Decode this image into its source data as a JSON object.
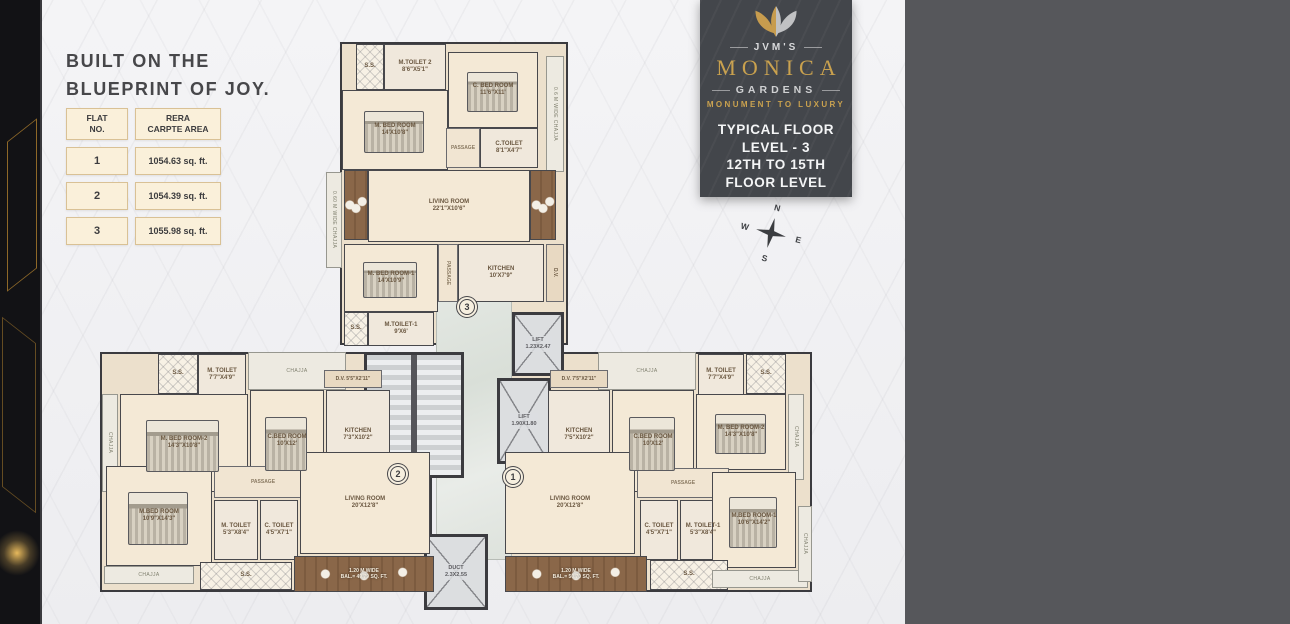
{
  "headline": {
    "text": "BUILT ON THE\nBLUEPRINT OF JOY."
  },
  "area_table": {
    "col1_header": "FLAT\nNO.",
    "col2_header": "RERA\nCARPTE AREA",
    "rows": [
      {
        "flat": "1",
        "area": "1054.63 sq. ft."
      },
      {
        "flat": "2",
        "area": "1054.39 sq. ft."
      },
      {
        "flat": "3",
        "area": "1055.98 sq. ft."
      }
    ]
  },
  "brand": {
    "name_prefix": "JVM'S",
    "name": "MONICA",
    "name_suffix": "GARDENS",
    "tagline": "MONUMENT TO LUXURY",
    "floor_info": "TYPICAL FLOOR\nLEVEL - 3\n12TH TO 15TH\nFLOOR LEVEL",
    "gold": "#c9a14e"
  },
  "compass": {
    "north": "N",
    "east": "E",
    "south": "S",
    "west": "W"
  },
  "floor_plan": {
    "flat_markers": [
      {
        "no": "3",
        "x": 467,
        "y": 307
      },
      {
        "no": "2",
        "x": 398,
        "y": 474
      },
      {
        "no": "1",
        "x": 513,
        "y": 477
      }
    ],
    "outlines": [
      {
        "name": "flat-3-outline",
        "x": 340,
        "y": 42,
        "w": 228,
        "h": 303
      },
      {
        "name": "flat-2-outline",
        "x": 100,
        "y": 352,
        "w": 332,
        "h": 240
      },
      {
        "name": "flat-1-outline",
        "x": 505,
        "y": 352,
        "w": 307,
        "h": 240
      }
    ],
    "rooms": [
      {
        "name": "lobby",
        "type": "lobby",
        "label": "",
        "x": 436,
        "y": 268,
        "w": 76,
        "h": 292
      },
      {
        "name": "staircase",
        "type": "stairs",
        "label": "",
        "x": 364,
        "y": 352,
        "w": 100,
        "h": 126
      },
      {
        "name": "lift-1",
        "type": "lift",
        "label": "LIFT\n1.23X2.47",
        "x": 512,
        "y": 312,
        "w": 52,
        "h": 64
      },
      {
        "name": "lift-2",
        "type": "lift",
        "label": "LIFT\n1.90X1.80",
        "x": 497,
        "y": 378,
        "w": 54,
        "h": 86
      },
      {
        "name": "duct",
        "type": "duct",
        "label": "DUCT\n2.3X2.55",
        "x": 424,
        "y": 534,
        "w": 64,
        "h": 76
      },
      {
        "name": "flat3-ss-top",
        "type": "ss",
        "label": "S.S.",
        "x": 356,
        "y": 44,
        "w": 28,
        "h": 46
      },
      {
        "name": "flat3-m-toilet-2",
        "type": "wet",
        "label": "M.TOILET 2\n8'6\"X5'1\"",
        "x": 384,
        "y": 44,
        "w": 62,
        "h": 46
      },
      {
        "name": "flat3-c-bed-room",
        "type": "room",
        "furn": "bed",
        "label": "C. BED ROOM\n11'6\"X11'",
        "x": 448,
        "y": 52,
        "w": 90,
        "h": 76
      },
      {
        "name": "flat3-m-bed-room",
        "type": "room",
        "furn": "bed",
        "label": "M. BED ROOM\n14'X10'8\"",
        "x": 342,
        "y": 90,
        "w": 106,
        "h": 80
      },
      {
        "name": "flat3-passage-a",
        "type": "pass",
        "label": "PASSAGE",
        "x": 446,
        "y": 128,
        "w": 34,
        "h": 40
      },
      {
        "name": "flat3-c-toilet",
        "type": "wet",
        "label": "C.TOILET\n8'1\"X4'7\"",
        "x": 480,
        "y": 128,
        "w": 58,
        "h": 40
      },
      {
        "name": "flat3-chajja-right",
        "type": "chajja",
        "vert": true,
        "label": "0.6 M WIDE CHAJJA",
        "x": 546,
        "y": 56,
        "w": 18,
        "h": 116
      },
      {
        "name": "flat3-balcony-left",
        "type": "balcony",
        "label": "",
        "x": 344,
        "y": 170,
        "w": 24,
        "h": 70
      },
      {
        "name": "flat3-living-room",
        "type": "room",
        "label": "LIVING ROOM\n22'1\"X10'6\"",
        "x": 368,
        "y": 170,
        "w": 162,
        "h": 72
      },
      {
        "name": "flat3-balcony-right",
        "type": "balcony",
        "label": "",
        "x": 530,
        "y": 170,
        "w": 26,
        "h": 70
      },
      {
        "name": "flat3-chajja-left",
        "type": "chajja",
        "vert": true,
        "label": "0.60 M WIDE CHAJJA",
        "x": 326,
        "y": 172,
        "w": 16,
        "h": 96
      },
      {
        "name": "flat3-m-bed-room-1",
        "type": "room",
        "furn": "bed",
        "label": "M. BED ROOM-1\n14'X10'9\"",
        "x": 344,
        "y": 244,
        "w": 94,
        "h": 68
      },
      {
        "name": "flat3-passage-b",
        "type": "pass",
        "vert": true,
        "label": "PASSAGE",
        "x": 438,
        "y": 244,
        "w": 20,
        "h": 58
      },
      {
        "name": "flat3-kitchen",
        "type": "wet",
        "label": "KITCHEN\n10'X7'9\"",
        "x": 458,
        "y": 244,
        "w": 86,
        "h": 58
      },
      {
        "name": "flat3-dv",
        "type": "dv",
        "vert": true,
        "label": "D.V.",
        "x": 546,
        "y": 244,
        "w": 18,
        "h": 58
      },
      {
        "name": "flat3-ss-bottom",
        "type": "ss",
        "label": "S.S.",
        "x": 344,
        "y": 312,
        "w": 24,
        "h": 34
      },
      {
        "name": "flat3-m-toilet-1",
        "type": "wet",
        "label": "M.TOILET-1\n9'X6'",
        "x": 368,
        "y": 312,
        "w": 66,
        "h": 34
      },
      {
        "name": "flat2-ss-top",
        "type": "ss",
        "label": "S.S.",
        "x": 158,
        "y": 354,
        "w": 40,
        "h": 40
      },
      {
        "name": "flat2-m-toilet",
        "type": "wet",
        "label": "M. TOILET\n7'7\"X4'9\"",
        "x": 198,
        "y": 354,
        "w": 48,
        "h": 42
      },
      {
        "name": "flat2-chajja-top",
        "type": "chajja",
        "label": "CHAJJA",
        "x": 248,
        "y": 352,
        "w": 98,
        "h": 38
      },
      {
        "name": "flat2-chajja-left",
        "type": "chajja",
        "vert": true,
        "label": "CHAJJA",
        "x": 102,
        "y": 394,
        "w": 16,
        "h": 98
      },
      {
        "name": "flat2-m-bed-room-2",
        "type": "room",
        "furn": "bed",
        "label": "M. BED ROOM-2\n14'3\"X10'8\"",
        "x": 120,
        "y": 394,
        "w": 128,
        "h": 98
      },
      {
        "name": "flat2-c-bed-room",
        "type": "room",
        "furn": "bed",
        "label": "C.BED ROOM\n10'X12'",
        "x": 250,
        "y": 390,
        "w": 74,
        "h": 102
      },
      {
        "name": "flat2-dv",
        "type": "dv",
        "label": "D.V. 5'5\"X2'11\"",
        "x": 324,
        "y": 370,
        "w": 58,
        "h": 18
      },
      {
        "name": "flat2-kitchen",
        "type": "wet",
        "label": "KITCHEN\n7'3\"X10'2\"",
        "x": 326,
        "y": 390,
        "w": 64,
        "h": 90
      },
      {
        "name": "flat2-m-bed-room",
        "type": "room",
        "furn": "bed",
        "label": "M.BED ROOM\n10'9\"X14'3\"",
        "x": 106,
        "y": 466,
        "w": 106,
        "h": 100
      },
      {
        "name": "flat2-passage",
        "type": "pass",
        "label": "PASSAGE",
        "x": 214,
        "y": 466,
        "w": 98,
        "h": 32
      },
      {
        "name": "flat2-m-toilet-b",
        "type": "wet",
        "label": "M. TOILET\n5'3\"X8'4\"",
        "x": 214,
        "y": 500,
        "w": 44,
        "h": 60
      },
      {
        "name": "flat2-c-toilet",
        "type": "wet",
        "label": "C. TOILET\n4'5\"X7'1\"",
        "x": 260,
        "y": 500,
        "w": 38,
        "h": 60
      },
      {
        "name": "flat2-living-room",
        "type": "room",
        "label": "LIVING ROOM\n20'X12'8\"",
        "x": 300,
        "y": 452,
        "w": 130,
        "h": 102
      },
      {
        "name": "flat2-ss-bottom",
        "type": "ss",
        "label": "S.S.",
        "x": 200,
        "y": 562,
        "w": 92,
        "h": 28
      },
      {
        "name": "flat2-balcony",
        "type": "balcony",
        "label": "1.20 M WIDE\nBAL.= 49.79 SQ. FT.",
        "x": 294,
        "y": 556,
        "w": 140,
        "h": 36
      },
      {
        "name": "flat2-chajja-bottom",
        "type": "chajja",
        "label": "CHAJJA",
        "x": 104,
        "y": 566,
        "w": 90,
        "h": 18
      },
      {
        "name": "flat1-chajja-top",
        "type": "chajja",
        "label": "CHAJJA",
        "x": 598,
        "y": 352,
        "w": 98,
        "h": 38
      },
      {
        "name": "flat1-m-toilet",
        "type": "wet",
        "label": "M. TOILET\n7'7\"X4'9\"",
        "x": 698,
        "y": 354,
        "w": 46,
        "h": 42
      },
      {
        "name": "flat1-ss-top",
        "type": "ss",
        "label": "S.S.",
        "x": 746,
        "y": 354,
        "w": 40,
        "h": 40
      },
      {
        "name": "flat1-dv",
        "type": "dv",
        "label": "D.V. 7'5\"X2'11\"",
        "x": 550,
        "y": 370,
        "w": 58,
        "h": 18
      },
      {
        "name": "flat1-kitchen",
        "type": "wet",
        "label": "KITCHEN\n7'5\"X10'2\"",
        "x": 548,
        "y": 390,
        "w": 62,
        "h": 90
      },
      {
        "name": "flat1-c-bed-room",
        "type": "room",
        "furn": "bed",
        "label": "C.BED ROOM\n10'X12'",
        "x": 612,
        "y": 390,
        "w": 82,
        "h": 102
      },
      {
        "name": "flat1-m-bed-room-2",
        "type": "room",
        "furn": "bed",
        "label": "M. BED ROOM-2\n14'3\"X10'8\"",
        "x": 696,
        "y": 394,
        "w": 90,
        "h": 76
      },
      {
        "name": "flat1-chajja-right-a",
        "type": "chajja",
        "vert": true,
        "label": "CHAJJA",
        "x": 788,
        "y": 394,
        "w": 16,
        "h": 86
      },
      {
        "name": "flat1-living-room",
        "type": "room",
        "label": "LIVING ROOM\n20'X12'8\"",
        "x": 505,
        "y": 452,
        "w": 130,
        "h": 102
      },
      {
        "name": "flat1-passage",
        "type": "pass",
        "label": "PASSAGE",
        "x": 637,
        "y": 468,
        "w": 92,
        "h": 30
      },
      {
        "name": "flat1-c-toilet",
        "type": "wet",
        "label": "C. TOILET\n4'5\"X7'1\"",
        "x": 640,
        "y": 500,
        "w": 38,
        "h": 60
      },
      {
        "name": "flat1-m-toilet-1",
        "type": "wet",
        "label": "M. TOILET-1\n5'3\"X8'4\"",
        "x": 680,
        "y": 500,
        "w": 46,
        "h": 60
      },
      {
        "name": "flat1-m-bed-room-1",
        "type": "room",
        "furn": "bed",
        "label": "M.BED ROOM-1\n10'6\"X14'2\"",
        "x": 712,
        "y": 472,
        "w": 84,
        "h": 96
      },
      {
        "name": "flat1-balcony",
        "type": "balcony",
        "label": "1.20 M WIDE\nBAL.= 50.70 SQ. FT.",
        "x": 505,
        "y": 556,
        "w": 142,
        "h": 36
      },
      {
        "name": "flat1-ss-bottom",
        "type": "ss",
        "label": "S.S.",
        "x": 650,
        "y": 560,
        "w": 78,
        "h": 30
      },
      {
        "name": "flat1-chajja-bottom",
        "type": "chajja",
        "label": "CHAJJA",
        "x": 712,
        "y": 570,
        "w": 96,
        "h": 18
      },
      {
        "name": "flat1-chajja-right-b",
        "type": "chajja",
        "vert": true,
        "label": "CHAJJA",
        "x": 798,
        "y": 506,
        "w": 14,
        "h": 76
      }
    ]
  }
}
